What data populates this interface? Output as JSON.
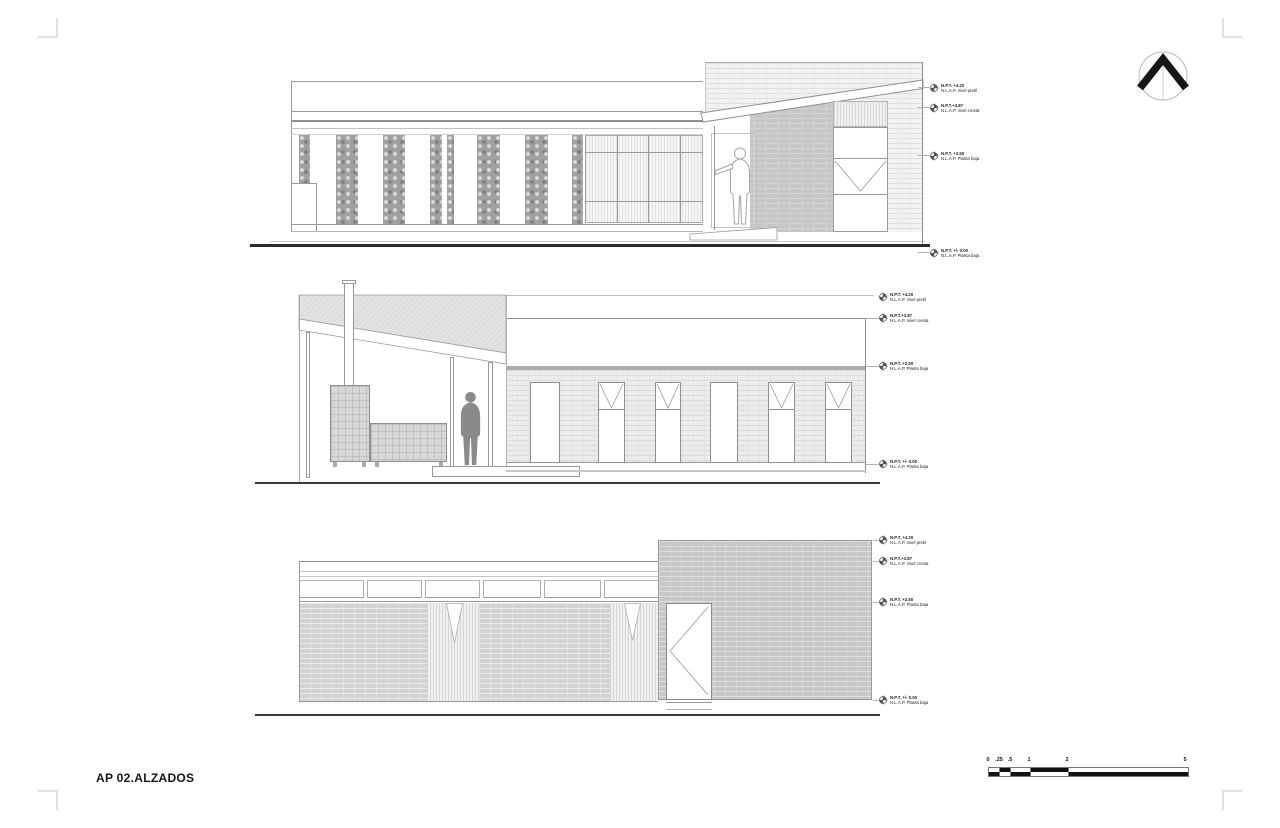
{
  "sheet": {
    "title": "AP 02.ALZADOS"
  },
  "levels": {
    "l1": {
      "line1": "N.P.T. +4.20",
      "line2": "N.L.A.P. nivel pretil"
    },
    "l2": {
      "line1": "N.P.T.+3.87",
      "line2": "N.L.A.P. nivel cresta"
    },
    "l3": {
      "line1": "N.P.T. +2.50",
      "line2": "N.L.A.P. Planta baja"
    },
    "l4": {
      "line1": "N.P.T. +/- 0.00",
      "line2": "N.L.A.P. Planta baja"
    }
  },
  "scalebar": {
    "labels": [
      "0",
      ".25",
      ".5",
      "1",
      "2",
      "5"
    ]
  },
  "colors": {
    "ink": "#1a1a1a",
    "line": "#999999",
    "ground": "#333333",
    "brick_light": "#f2f2f2",
    "brick_mid": "#c7c7c7",
    "gabion": "#a0a0a0"
  }
}
